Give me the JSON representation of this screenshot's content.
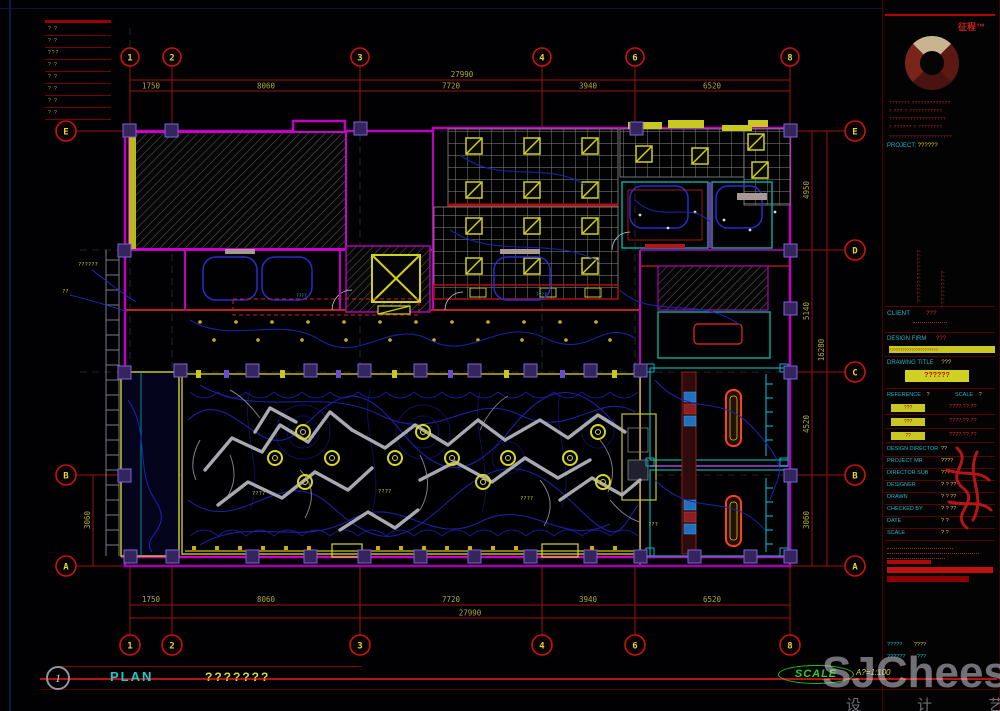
{
  "rev_table": {
    "rows": [
      "? ?",
      "? ?",
      "???",
      "? ?",
      "? ?",
      "? ?",
      "? ?",
      "? ?"
    ]
  },
  "grid": {
    "top_labels": [
      "1",
      "2",
      "3",
      "4",
      "6",
      "8"
    ],
    "bottom_labels": [
      "1",
      "2",
      "3",
      "4",
      "6",
      "8"
    ],
    "right_labels": [
      "E",
      "D",
      "C",
      "B",
      "A"
    ],
    "left_labels": [
      "E",
      "B",
      "A"
    ],
    "dims_top": [
      "1750",
      "8060",
      "7720",
      "3940",
      "6520"
    ],
    "dims_top_total": "27990",
    "dims_bottom": [
      "1750",
      "8060",
      "7720",
      "3940",
      "6520"
    ],
    "dims_bottom_total": "27990",
    "dims_right": [
      "4950",
      "5140",
      "4520",
      "3060"
    ],
    "dims_right_total": "16280",
    "dim_left": "3060"
  },
  "annotations": {
    "note1": "??????",
    "note2": "??",
    "hall_note1": "????",
    "hall_note2": "????",
    "hall_note3": "????",
    "cyan_dim1": "????",
    "cyan_dim2": "????",
    "room_note": "???"
  },
  "titleblock": {
    "brand": "征程™",
    "company_lines": [
      "??????? ?????????????",
      "? ??? ? ???????????",
      "???????????????????",
      "? ?????? ? ????????"
    ],
    "address_line": "?????????????????????",
    "project_label": "PROJECT:",
    "project_value": "??????",
    "notes_v1": "??????????????",
    "notes_v2": "??????????",
    "client_label": "CLIENT",
    "client_value": "???",
    "firm_label": "DESIGN FIRM",
    "firm_value": "???",
    "firm_bar_text": "??????????????????????",
    "title_label": "DRAWING TITLE",
    "title_value": "???",
    "title_highlight": "??????",
    "ref_label": "REFERENCE",
    "ref_value": "?",
    "scale_label": "SCALE",
    "scale_value": "?",
    "tags": [
      "???",
      "???",
      "??"
    ],
    "dates": [
      "????.??.??",
      "????.??.??",
      "????.??.??"
    ],
    "rows": [
      {
        "label": "DESIGN DIRECTOR",
        "value": "??"
      },
      {
        "label": "PROJECT MR",
        "value": "????"
      },
      {
        "label": "DIRECTOR SUB",
        "value": "???"
      },
      {
        "label": "DESIGNER",
        "value": "? ? ??"
      },
      {
        "label": "DRAWN",
        "value": "? ? ??"
      },
      {
        "label": "CHECKED BY",
        "value": "? ? ??"
      },
      {
        "label": "DATE",
        "value": "? ?"
      },
      {
        "label": "SCALE",
        "value": "? ?"
      }
    ],
    "bottom_row1_label": "?????",
    "bottom_row1_value": "????",
    "bottom_row2_label": "??????",
    "bottom_row2_value": "???"
  },
  "footer": {
    "detail_number": "1",
    "plan_label": "PLAN",
    "plan_value": "???????",
    "scale_label": "SCALE",
    "scale_value": "A?=1:100"
  },
  "watermark": {
    "line1": "SJCheese",
    "line2": "设 计 艺 士"
  }
}
